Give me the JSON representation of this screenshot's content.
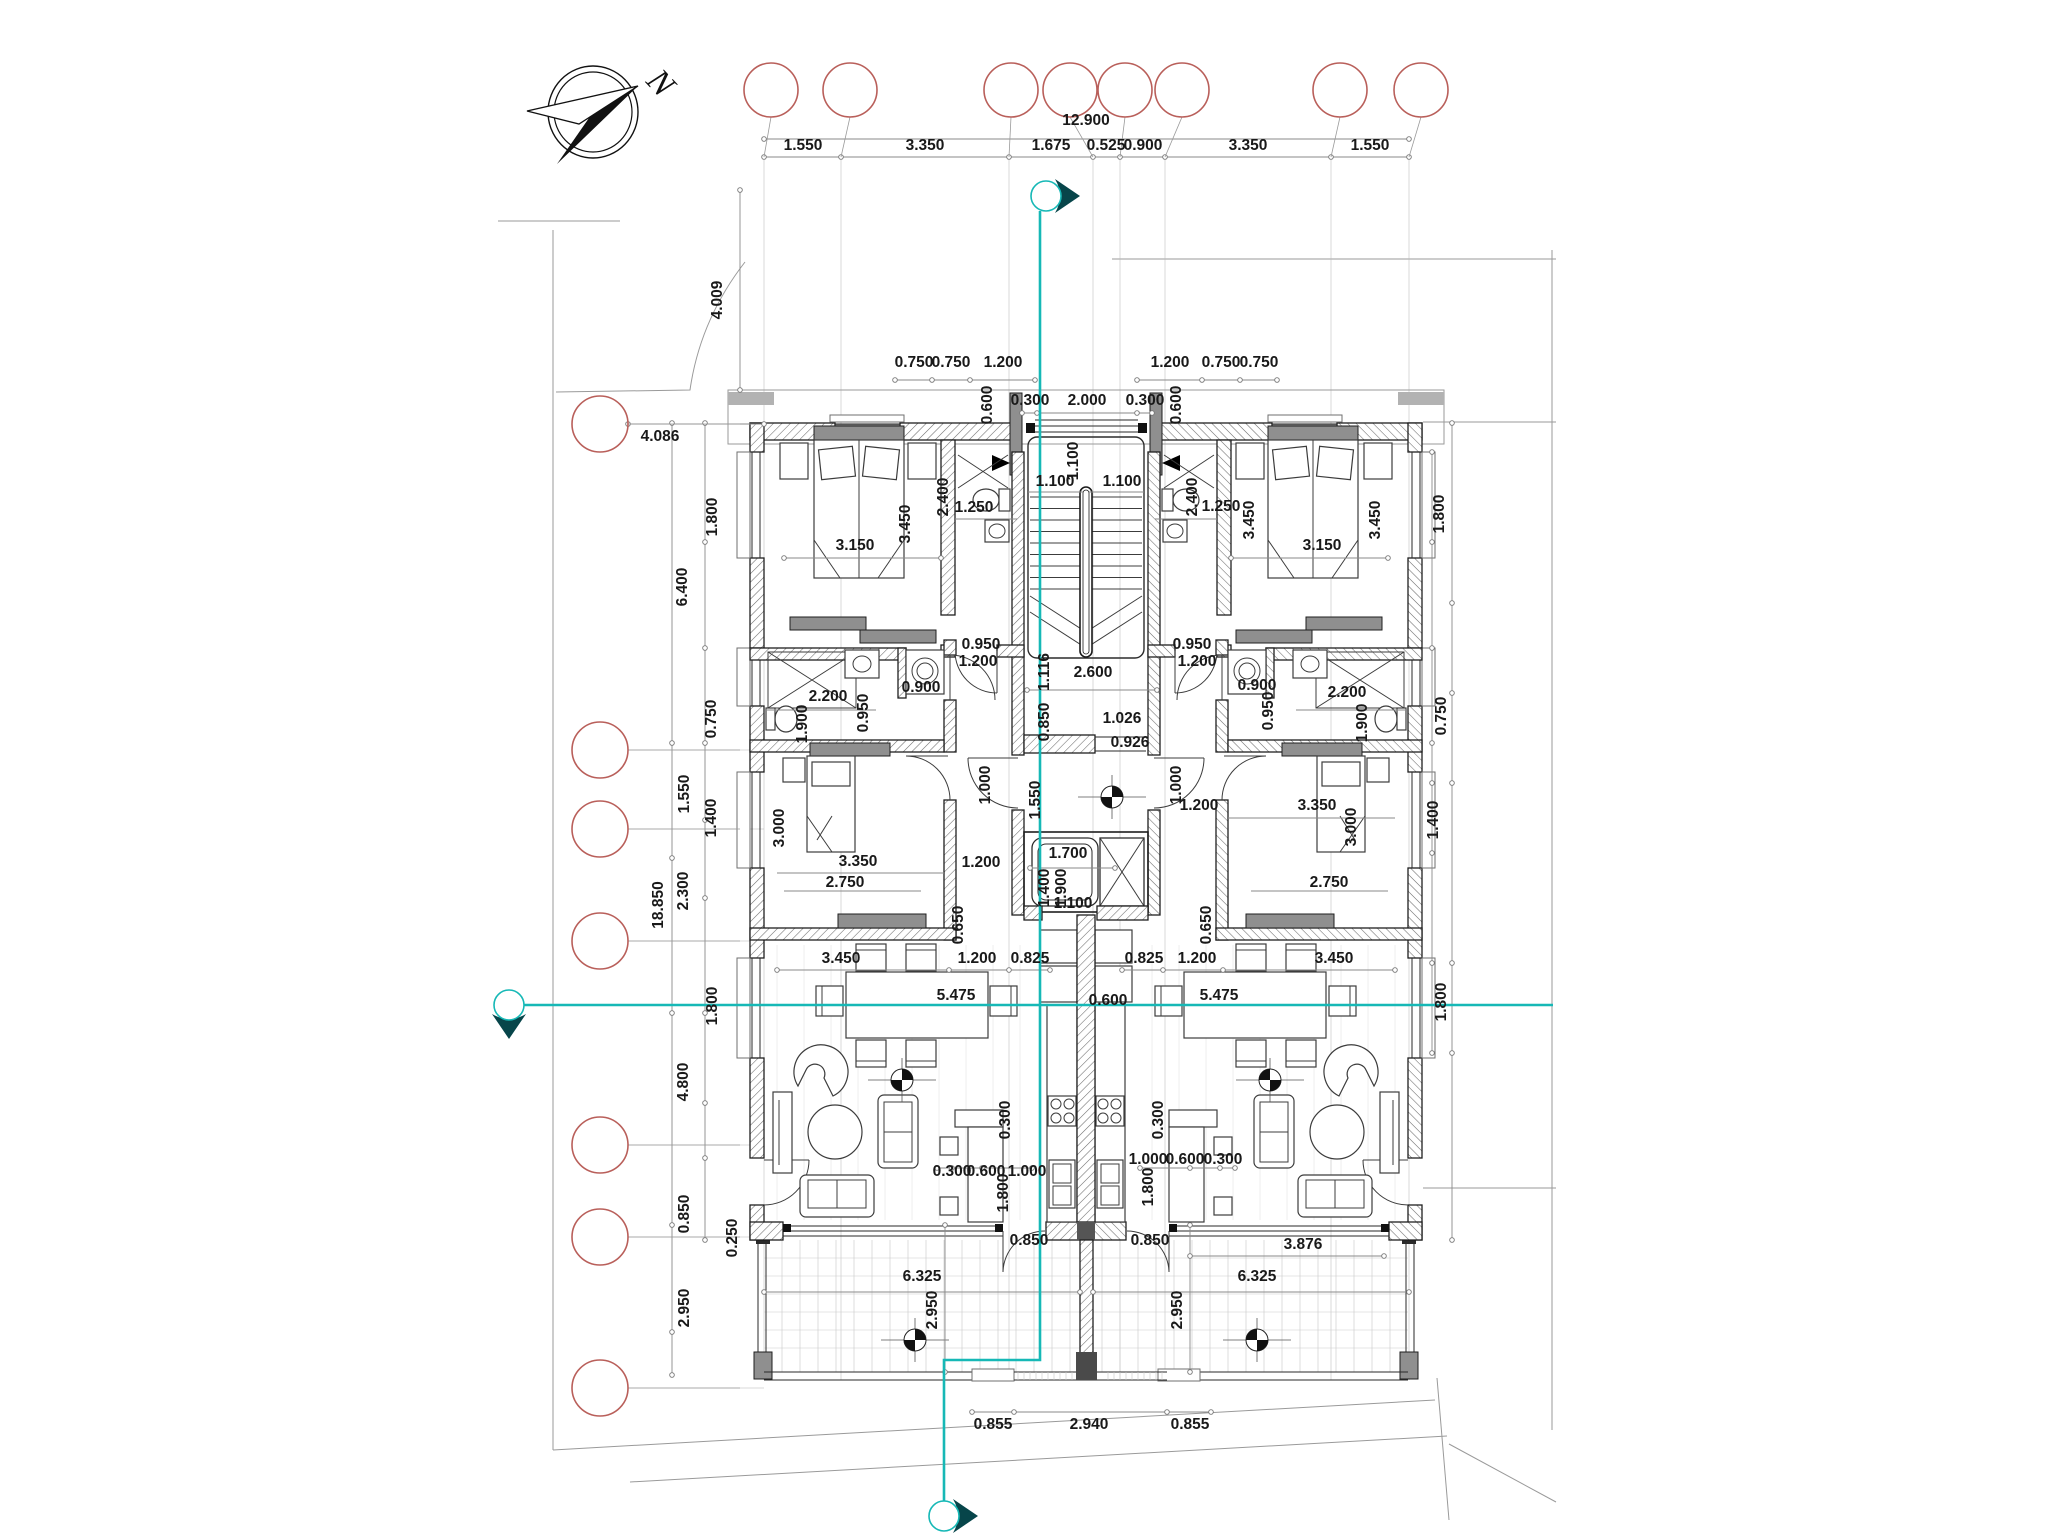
{
  "drawing": {
    "type": "architectural-floor-plan",
    "compass_label": "N",
    "colors": {
      "section_line": "#16b8b6",
      "section_arrow": "#07454a",
      "grid_bubble": "#b95f5a",
      "wall": "#1f1f1f",
      "dim_text": "#191919",
      "dim_line": "#8a8a8a"
    },
    "grid": {
      "top_bubbles": [
        {
          "x": 771,
          "target": 764
        },
        {
          "x": 850,
          "target": 841
        },
        {
          "x": 1011,
          "target": 1009
        },
        {
          "x": 1070,
          "target": 1093
        },
        {
          "x": 1125,
          "target": 1120
        },
        {
          "x": 1182,
          "target": 1165
        },
        {
          "x": 1340,
          "target": 1331
        },
        {
          "x": 1421,
          "target": 1409
        }
      ],
      "top_bubble_y": 90,
      "left_bubbles": [
        424,
        750,
        829,
        941,
        1145,
        1237,
        1388
      ],
      "left_bubble_x": 600
    },
    "section_markers": {
      "vertical": {
        "x": 1040,
        "top_circle": {
          "cx": 1046,
          "cy": 196
        },
        "jog_y": 1360,
        "x2": 944,
        "bottom_circle": {
          "cx": 944,
          "cy": 1516
        }
      },
      "horizontal": {
        "y": 1005,
        "x1": 524,
        "x2": 1553,
        "left_circle": {
          "cx": 509,
          "cy": 1005
        }
      }
    },
    "dim_labels": [
      {
        "t": "12.900",
        "x": 1086,
        "y": 125
      },
      {
        "t": "1.550",
        "x": 803,
        "y": 150
      },
      {
        "t": "3.350",
        "x": 925,
        "y": 150
      },
      {
        "t": "1.675",
        "x": 1051,
        "y": 150
      },
      {
        "t": "0.525",
        "x": 1106,
        "y": 150
      },
      {
        "t": "0.900",
        "x": 1143,
        "y": 150
      },
      {
        "t": "3.350",
        "x": 1248,
        "y": 150
      },
      {
        "t": "1.550",
        "x": 1370,
        "y": 150
      },
      {
        "t": "4.009",
        "x": 722,
        "y": 300,
        "r": 1
      },
      {
        "t": "4.086",
        "x": 660,
        "y": 441
      },
      {
        "t": "0.750",
        "x": 914,
        "y": 367
      },
      {
        "t": "0.750",
        "x": 951,
        "y": 367
      },
      {
        "t": "1.200",
        "x": 1003,
        "y": 367
      },
      {
        "t": "1.200",
        "x": 1170,
        "y": 367
      },
      {
        "t": "0.750",
        "x": 1221,
        "y": 367
      },
      {
        "t": "0.750",
        "x": 1259,
        "y": 367
      },
      {
        "t": "0.300",
        "x": 1030,
        "y": 405
      },
      {
        "t": "2.000",
        "x": 1087,
        "y": 405
      },
      {
        "t": "0.300",
        "x": 1145,
        "y": 405
      },
      {
        "t": "0.600",
        "x": 992,
        "y": 405,
        "r": 1
      },
      {
        "t": "0.600",
        "x": 1181,
        "y": 405,
        "r": 1
      },
      {
        "t": "1.800",
        "x": 717,
        "y": 517,
        "r": 1
      },
      {
        "t": "6.400",
        "x": 687,
        "y": 587,
        "r": 1
      },
      {
        "t": "0.750",
        "x": 716,
        "y": 719,
        "r": 1
      },
      {
        "t": "1.550",
        "x": 689,
        "y": 794,
        "r": 1
      },
      {
        "t": "1.400",
        "x": 716,
        "y": 818,
        "r": 1
      },
      {
        "t": "2.300",
        "x": 688,
        "y": 891,
        "r": 1
      },
      {
        "t": "18.850",
        "x": 663,
        "y": 905,
        "r": 1
      },
      {
        "t": "1.800",
        "x": 717,
        "y": 1006,
        "r": 1
      },
      {
        "t": "4.800",
        "x": 688,
        "y": 1082,
        "r": 1
      },
      {
        "t": "0.850",
        "x": 689,
        "y": 1214,
        "r": 1
      },
      {
        "t": "0.250",
        "x": 737,
        "y": 1238,
        "r": 1
      },
      {
        "t": "2.950",
        "x": 689,
        "y": 1308,
        "r": 1
      },
      {
        "t": "1.800",
        "x": 1444,
        "y": 514,
        "r": 1
      },
      {
        "t": "0.750",
        "x": 1446,
        "y": 716,
        "r": 1
      },
      {
        "t": "1.400",
        "x": 1438,
        "y": 820,
        "r": 1
      },
      {
        "t": "1.800",
        "x": 1446,
        "y": 1002,
        "r": 1
      },
      {
        "t": "3.150",
        "x": 855,
        "y": 550
      },
      {
        "t": "3.450",
        "x": 910,
        "y": 524,
        "r": 1
      },
      {
        "t": "3.150",
        "x": 1322,
        "y": 550
      },
      {
        "t": "3.450",
        "x": 1254,
        "y": 520,
        "r": 1
      },
      {
        "t": "3.450",
        "x": 1380,
        "y": 520,
        "r": 1
      },
      {
        "t": "2.400",
        "x": 948,
        "y": 497,
        "r": 1
      },
      {
        "t": "1.250",
        "x": 974,
        "y": 512
      },
      {
        "t": "2.400",
        "x": 1197,
        "y": 497,
        "r": 1
      },
      {
        "t": "1.250",
        "x": 1221,
        "y": 511
      },
      {
        "t": "1.100",
        "x": 1078,
        "y": 461,
        "r": 1
      },
      {
        "t": "1.100",
        "x": 1055,
        "y": 486
      },
      {
        "t": "1.100",
        "x": 1122,
        "y": 486
      },
      {
        "t": "2.200",
        "x": 828,
        "y": 701
      },
      {
        "t": "0.950",
        "x": 868,
        "y": 713,
        "r": 1
      },
      {
        "t": "0.900",
        "x": 921,
        "y": 692
      },
      {
        "t": "1.900",
        "x": 807,
        "y": 724,
        "r": 1
      },
      {
        "t": "2.200",
        "x": 1347,
        "y": 697
      },
      {
        "t": "0.950",
        "x": 1273,
        "y": 711,
        "r": 1
      },
      {
        "t": "0.900",
        "x": 1257,
        "y": 690
      },
      {
        "t": "1.900",
        "x": 1367,
        "y": 723,
        "r": 1
      },
      {
        "t": "0.950",
        "x": 981,
        "y": 649
      },
      {
        "t": "1.200",
        "x": 978,
        "y": 666
      },
      {
        "t": "0.950",
        "x": 1192,
        "y": 649
      },
      {
        "t": "1.200",
        "x": 1197,
        "y": 666
      },
      {
        "t": "1.116",
        "x": 1049,
        "y": 672,
        "r": 1
      },
      {
        "t": "2.600",
        "x": 1093,
        "y": 677
      },
      {
        "t": "0.850",
        "x": 1049,
        "y": 722,
        "r": 1
      },
      {
        "t": "1.026",
        "x": 1122,
        "y": 723
      },
      {
        "t": "0.926",
        "x": 1130,
        "y": 747
      },
      {
        "t": "1.550",
        "x": 1040,
        "y": 800,
        "r": 1
      },
      {
        "t": "1.000",
        "x": 990,
        "y": 785,
        "r": 1
      },
      {
        "t": "1.000",
        "x": 1181,
        "y": 785,
        "r": 1
      },
      {
        "t": "1.200",
        "x": 1199,
        "y": 810
      },
      {
        "t": "1.200",
        "x": 981,
        "y": 867
      },
      {
        "t": "1.700",
        "x": 1068,
        "y": 858
      },
      {
        "t": "1.400",
        "x": 1049,
        "y": 888,
        "r": 1
      },
      {
        "t": "1.900",
        "x": 1066,
        "y": 888,
        "r": 1
      },
      {
        "t": "1.100",
        "x": 1073,
        "y": 908
      },
      {
        "t": "3.350",
        "x": 858,
        "y": 866
      },
      {
        "t": "2.750",
        "x": 845,
        "y": 887
      },
      {
        "t": "3.000",
        "x": 784,
        "y": 828,
        "r": 1
      },
      {
        "t": "0.650",
        "x": 963,
        "y": 925,
        "r": 1
      },
      {
        "t": "3.350",
        "x": 1317,
        "y": 810
      },
      {
        "t": "2.750",
        "x": 1329,
        "y": 887
      },
      {
        "t": "3.000",
        "x": 1356,
        "y": 827,
        "r": 1
      },
      {
        "t": "0.650",
        "x": 1211,
        "y": 925,
        "r": 1
      },
      {
        "t": "3.450",
        "x": 841,
        "y": 963
      },
      {
        "t": "1.200",
        "x": 977,
        "y": 963
      },
      {
        "t": "0.825",
        "x": 1030,
        "y": 963
      },
      {
        "t": "0.825",
        "x": 1144,
        "y": 963
      },
      {
        "t": "1.200",
        "x": 1197,
        "y": 963
      },
      {
        "t": "3.450",
        "x": 1334,
        "y": 963
      },
      {
        "t": "5.475",
        "x": 956,
        "y": 1000
      },
      {
        "t": "5.475",
        "x": 1219,
        "y": 1000
      },
      {
        "t": "0.600",
        "x": 1108,
        "y": 1005
      },
      {
        "t": "0.300",
        "x": 1010,
        "y": 1120,
        "r": 1
      },
      {
        "t": "0.300",
        "x": 1163,
        "y": 1120,
        "r": 1
      },
      {
        "t": "0.300",
        "x": 952,
        "y": 1176
      },
      {
        "t": "0.600",
        "x": 986,
        "y": 1176
      },
      {
        "t": "1.000",
        "x": 1027,
        "y": 1176
      },
      {
        "t": "1.000",
        "x": 1148,
        "y": 1164
      },
      {
        "t": "0.600",
        "x": 1185,
        "y": 1164
      },
      {
        "t": "0.300",
        "x": 1223,
        "y": 1164
      },
      {
        "t": "1.800",
        "x": 1008,
        "y": 1193,
        "r": 1
      },
      {
        "t": "1.800",
        "x": 1153,
        "y": 1187,
        "r": 1
      },
      {
        "t": "0.850",
        "x": 1029,
        "y": 1245
      },
      {
        "t": "0.850",
        "x": 1150,
        "y": 1245
      },
      {
        "t": "3.876",
        "x": 1303,
        "y": 1249
      },
      {
        "t": "6.325",
        "x": 922,
        "y": 1281
      },
      {
        "t": "6.325",
        "x": 1257,
        "y": 1281
      },
      {
        "t": "2.950",
        "x": 937,
        "y": 1310,
        "r": 1
      },
      {
        "t": "2.950",
        "x": 1182,
        "y": 1310,
        "r": 1
      },
      {
        "t": "0.855",
        "x": 993,
        "y": 1429
      },
      {
        "t": "2.940",
        "x": 1089,
        "y": 1429
      },
      {
        "t": "0.855",
        "x": 1190,
        "y": 1429
      }
    ]
  }
}
